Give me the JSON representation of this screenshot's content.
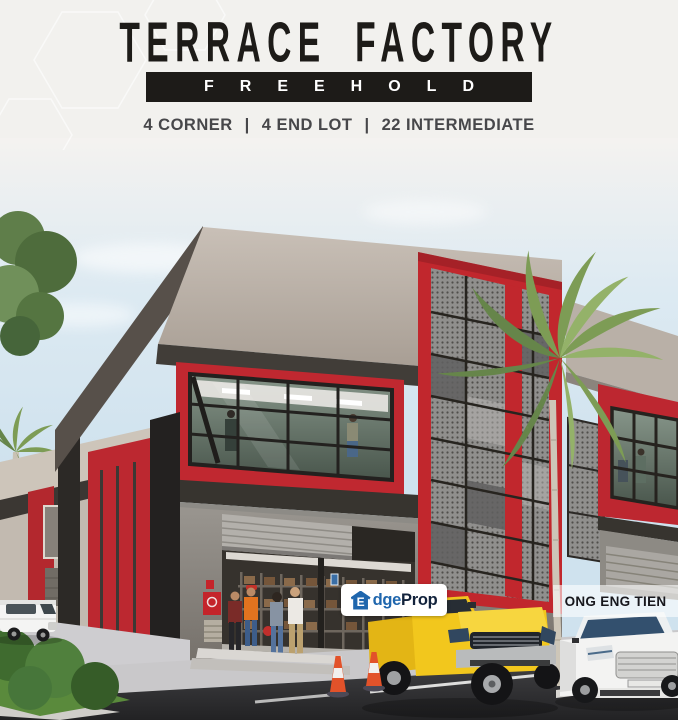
{
  "page": {
    "width": 678,
    "height": 720,
    "kind": "property-listing-advertisement"
  },
  "header": {
    "title": "TERRACE FACTORY",
    "banner": "FREEHOLD",
    "subtitle": {
      "part1": "4 CORNER",
      "part2": "4 END LOT",
      "part3": "22 INTERMEDIATE",
      "divider": "|"
    }
  },
  "overlays": {
    "edgeprop": {
      "full_name": "EdgeProp",
      "icon": "house-icon",
      "icon_letter": "E",
      "name_part1": "dge",
      "name_part2": "Prop"
    },
    "agent": {
      "name": "ONG ENG TIEN"
    }
  },
  "scene": {
    "kind": "3d-architectural-render",
    "elements": [
      "two-storey-terrace-factory",
      "red-mesh-feature-tower",
      "glass-office-curtain-wall",
      "roller-shutter-doors",
      "warehouse-racks",
      "palm-trees",
      "white-van",
      "yellow-pickup-truck",
      "white-sedan",
      "traffic-cones",
      "people",
      "landscaping",
      "road"
    ],
    "colors": {
      "accent_red": "#c1272d",
      "parapet_beige": "#b7aea5",
      "soffit_dark": "#3d3935",
      "sky_blue": "#cfe2ee",
      "mesh_gray": "#8f8e8c",
      "road_asphalt": "#2c2c2e",
      "grass_green": "#4e7c38",
      "truck_yellow": "#f2c71d",
      "edgeprop_blue": "#1f66ad",
      "edgeprop_dark": "#13233c",
      "banner_black": "#1d1b18"
    }
  }
}
